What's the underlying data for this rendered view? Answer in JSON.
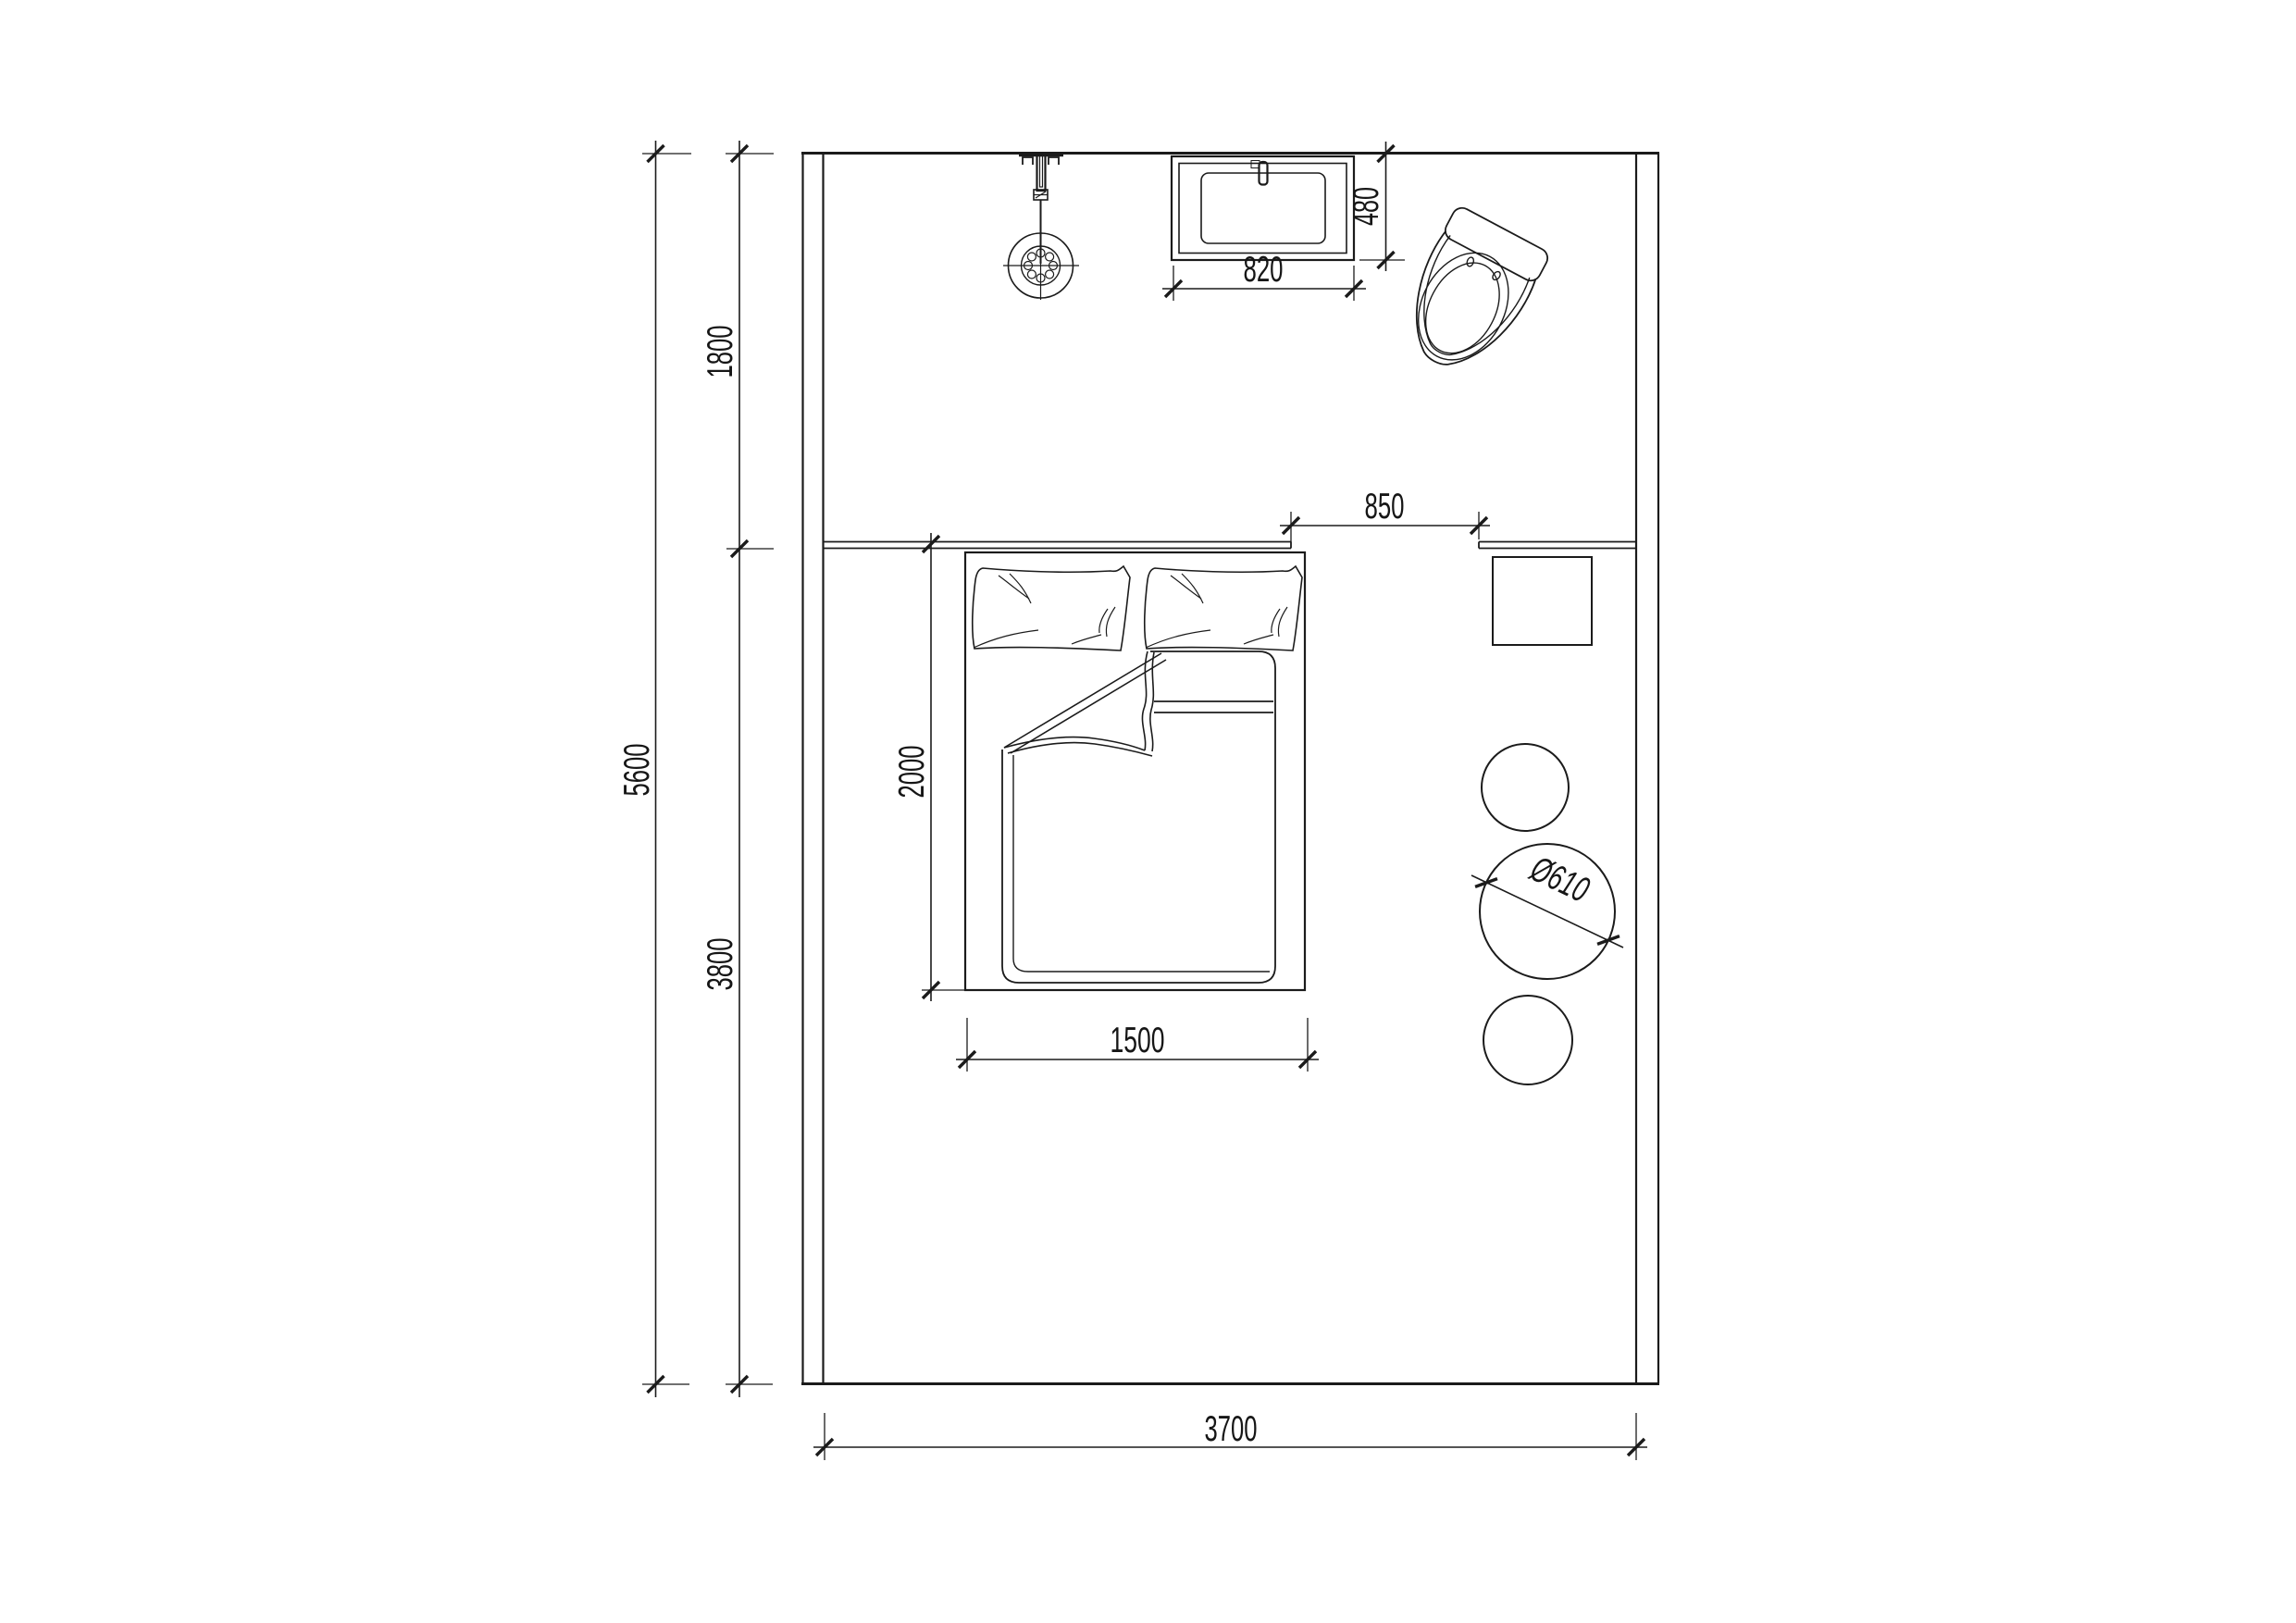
{
  "canvas": {
    "background": "#ffffff",
    "line_color": "#1b1b1b",
    "description": "Architectural plan drawing of a bedroom with shower zone: shower head, washbasin, toilet, double bed with pillows and folded duvet, bedside table, three round stools"
  },
  "dimensions": {
    "room_total_depth": "5600",
    "shower_zone_depth": "1800",
    "bedroom_zone_depth": "3800",
    "room_width": "3700",
    "vanity_width": "820",
    "vanity_depth": "480",
    "opening_width": "850",
    "bed_length": "2000",
    "bed_width": "1500",
    "stool_diameter": "Ø610"
  },
  "fixtures": {
    "shower": "ceiling shower head",
    "vanity": "washbasin counter",
    "toilet": "toilet",
    "bed": "double bed",
    "nightstand": "bedside table",
    "stools": "round stools"
  }
}
